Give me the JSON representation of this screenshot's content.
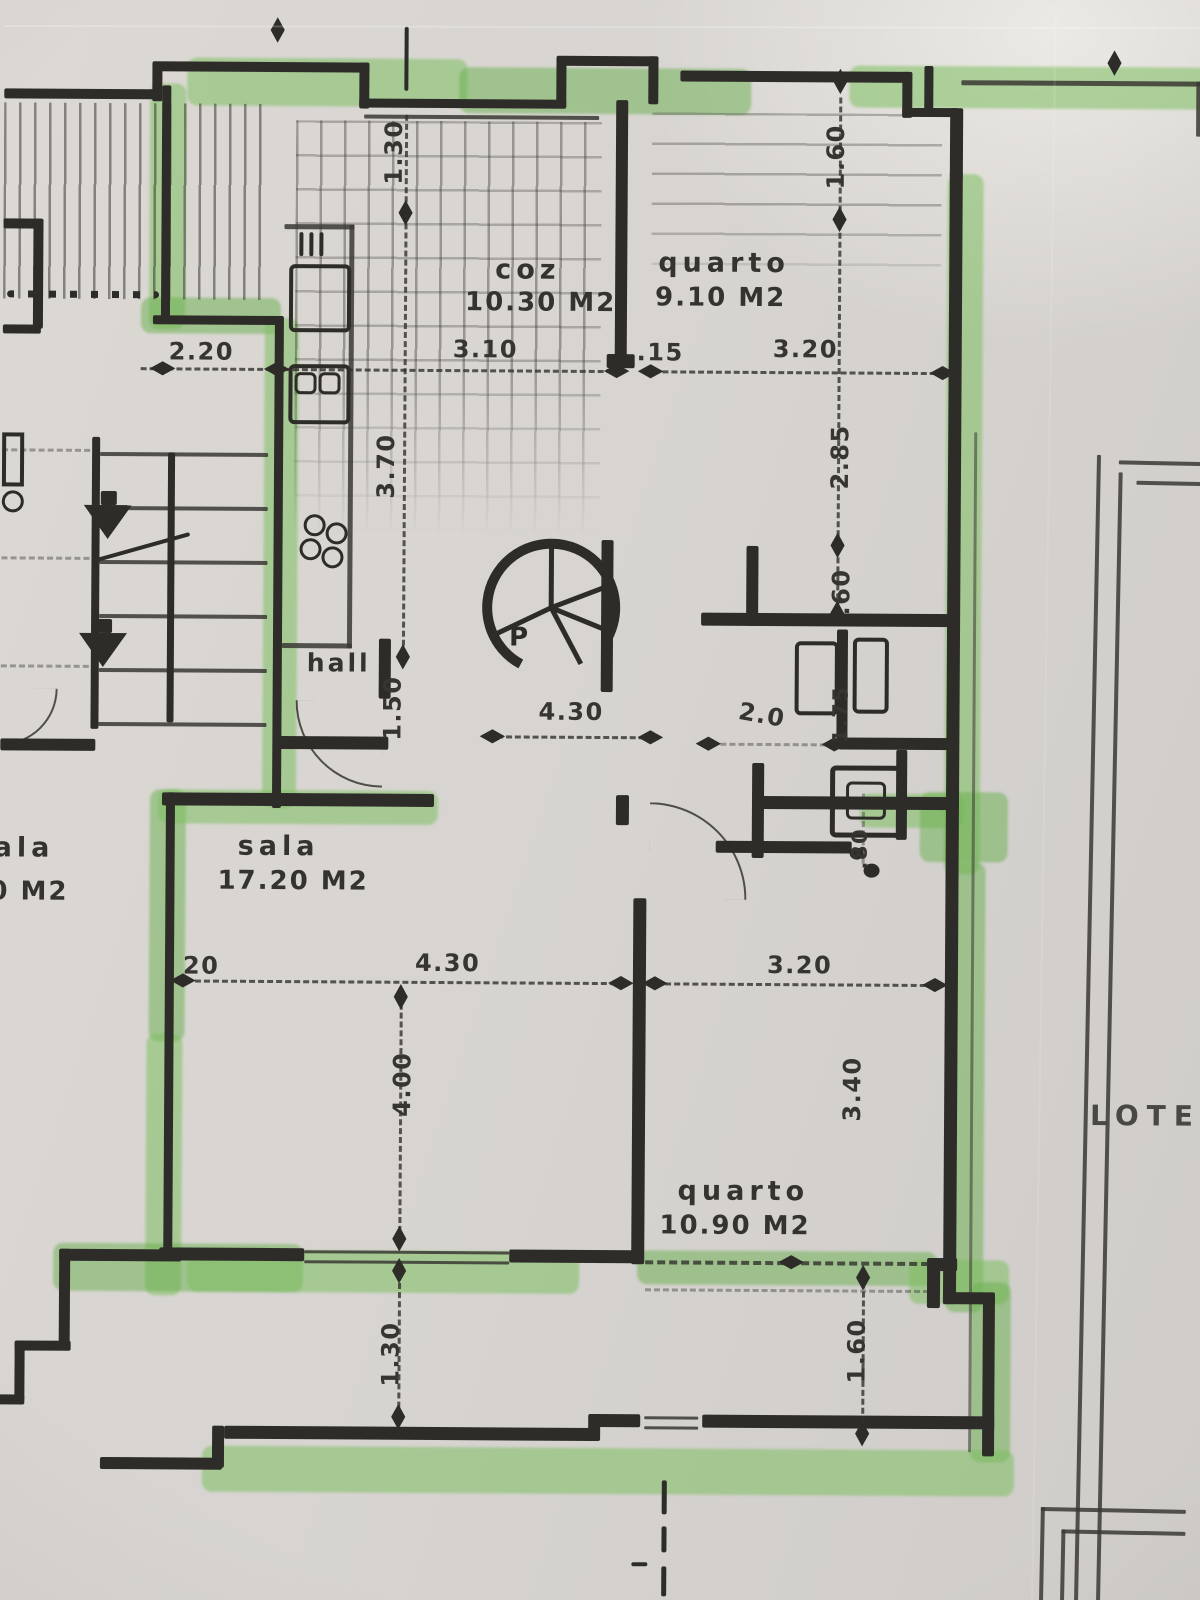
{
  "rooms": {
    "kitchen": {
      "name": "coz",
      "area": "10.30 M2"
    },
    "bedroom_top": {
      "name": "quarto",
      "area": "9.10 M2"
    },
    "living": {
      "name": "sala",
      "area": "17.20 M2"
    },
    "bedroom_bottom": {
      "name": "quarto",
      "area": "10.90 M2"
    },
    "hall": {
      "name": "hall"
    },
    "neighbor_room_clipped": {
      "name": "ala",
      "area": "0 M2"
    }
  },
  "annotations": {
    "lot_label": "LOTE",
    "stair_letter": "P"
  },
  "dimensions": {
    "top_center_depth": "1.30",
    "top_right_depth": "1.60",
    "left_width": "2.20",
    "kitchen_width": "3.10",
    "wall_thickness": ".15",
    "bedroom_top_width": "3.20",
    "bedroom_top_height": "2.85",
    "kitchen_height": "3.70",
    "niche_depth": ".60",
    "hall_depth": "1.50",
    "hall_width": "4.30",
    "bath_width": "2.0",
    "bath_height": "1.75",
    "bath_lower": ".80",
    "living_wall": "20",
    "living_width": "4.30",
    "living_height": "4.00",
    "bedroom_bottom_width": "3.20",
    "bedroom_bottom_height": "3.40",
    "bottom_center_depth": "1.30",
    "bottom_right_depth": "1.60"
  },
  "colors": {
    "highlighter": "#7fc163",
    "ink": "#2d2c28",
    "paper": "#d8d5d2"
  }
}
